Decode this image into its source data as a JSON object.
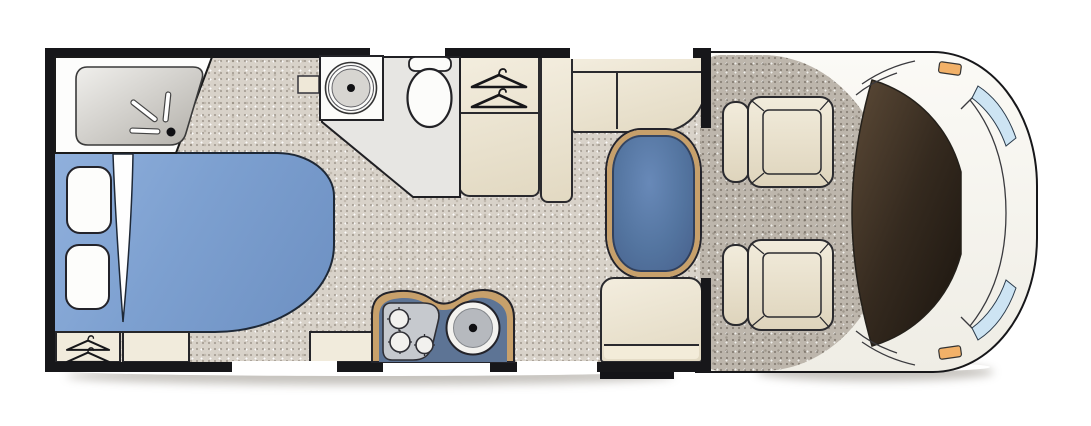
{
  "floorplan": {
    "type": "motorhome-floor-plan",
    "view": "top-down",
    "zones": [
      {
        "id": "bathroom",
        "fixtures": [
          "shower-tray",
          "shower-fittings",
          "washbasin",
          "toilet",
          "side-shelf"
        ]
      },
      {
        "id": "bedroom",
        "fixtures": [
          "double-bed",
          "pillow-upper",
          "pillow-lower",
          "duvet-fold",
          "underbed-hanger-wardrobe",
          "underbed-cabinet",
          "underbed-cabinet-2"
        ]
      },
      {
        "id": "wardrobe",
        "fixtures": [
          "hanging-rail",
          "lower-cupboard"
        ]
      },
      {
        "id": "kitchen",
        "fixtures": [
          "worktop",
          "three-burner-hob",
          "round-sink"
        ]
      },
      {
        "id": "dinette",
        "fixtures": [
          "l-shaped-bench",
          "pedestal-table",
          "forward-bench",
          "entry-step"
        ]
      },
      {
        "id": "cab",
        "fixtures": [
          "driver-seat",
          "passenger-seat",
          "dashboard-windscreen",
          "corner-glass-upper",
          "corner-glass-lower",
          "side-marker-upper",
          "side-marker-lower"
        ]
      }
    ],
    "openings": {
      "top_wall_windows": 2,
      "bottom_wall_openings": 3
    },
    "colors": {
      "wall": "#17171a",
      "floor": "#d8d2c9",
      "cab_floor": "#bdb6ac",
      "bed_blue": "#7da0d0",
      "table_blue": "#53749f",
      "kitchen_blue": "#5d7495",
      "wood_trim": "#c7a06b",
      "furniture_cream": "#ece5d3",
      "bathroom_floor": "#e7e6e3",
      "windscreen_brown": "#352a1f",
      "corner_glass_blue": "#cde4f3",
      "marker_orange": "#f2b168"
    }
  }
}
